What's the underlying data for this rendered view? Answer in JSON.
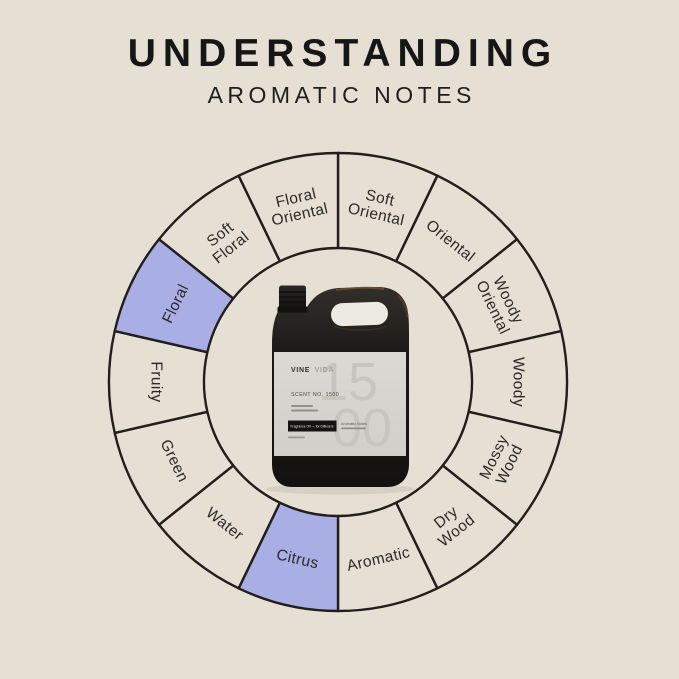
{
  "colors": {
    "background": "#e6dfd3",
    "highlight": "#a9aee4",
    "line": "#211e1b",
    "label_text": "#2b2a28",
    "title_text": "#161616"
  },
  "header": {
    "title": "UNDERSTANDING",
    "subtitle": "AROMATIC NOTES"
  },
  "wheel": {
    "segments": [
      {
        "label": "Soft Oriental",
        "highlighted": false
      },
      {
        "label": "Oriental",
        "highlighted": false
      },
      {
        "label": "Woody Oriental",
        "highlighted": false
      },
      {
        "label": "Woody",
        "highlighted": false
      },
      {
        "label": "Mossy Wood",
        "highlighted": false
      },
      {
        "label": "Dry Wood",
        "highlighted": false
      },
      {
        "label": "Aromatic",
        "highlighted": false
      },
      {
        "label": "Citrus",
        "highlighted": true
      },
      {
        "label": "Water",
        "highlighted": false
      },
      {
        "label": "Green",
        "highlighted": false
      },
      {
        "label": "Fruity",
        "highlighted": false
      },
      {
        "label": "Floral",
        "highlighted": true
      },
      {
        "label": "Soft Floral",
        "highlighted": false
      },
      {
        "label": "Floral Oriental",
        "highlighted": false
      }
    ]
  },
  "product": {
    "brand_bold": "VINE",
    "brand_light": "VIDA",
    "scent_line": "SCENT NO. 1500",
    "watermark_top": "15",
    "watermark_bottom": "00",
    "bar_label": "Fragrance Oil — for Diffusers",
    "aside_label": "Aromatic Notes"
  }
}
